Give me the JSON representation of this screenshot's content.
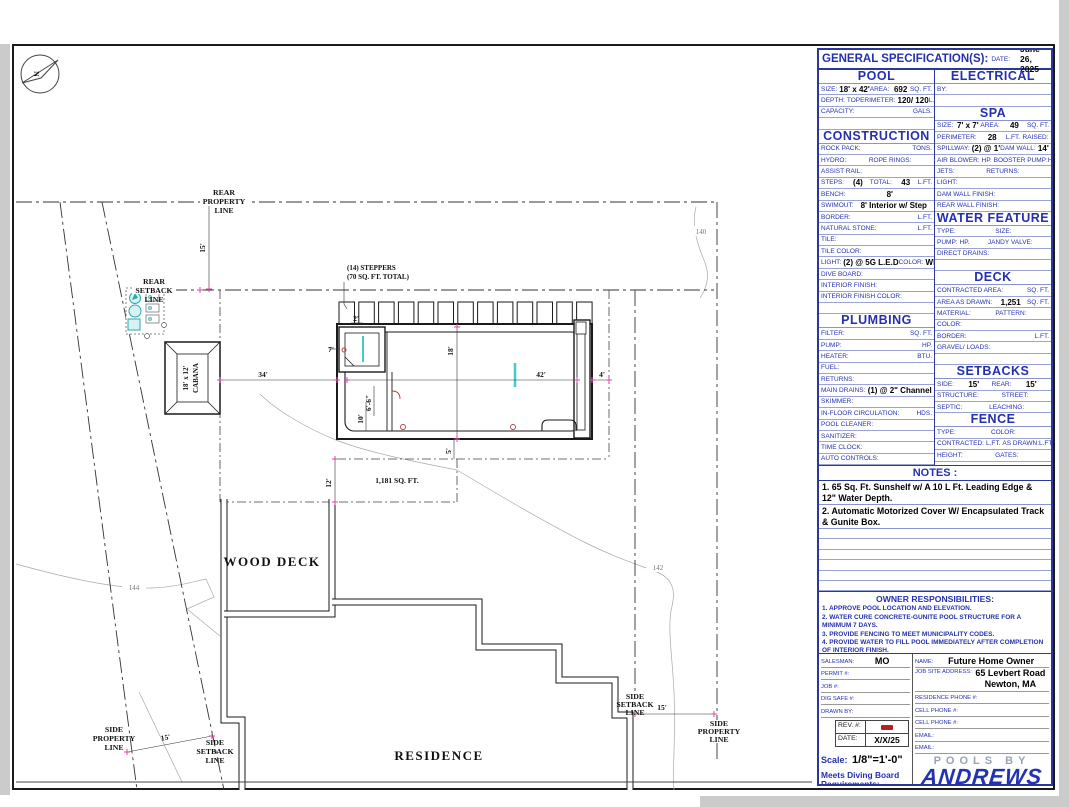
{
  "spec": {
    "title": "GENERAL SPECIFICATION(S):",
    "date_label": "DATE:",
    "date_value": "June 26, 2025",
    "left_sections": [
      {
        "header": "POOL",
        "rows": [
          [
            {
              "t": "SIZE:",
              "k": "l"
            },
            {
              "t": "18' x 42'",
              "k": "v"
            },
            {
              "t": "AREA:",
              "k": "l"
            },
            {
              "t": "692",
              "k": "v"
            },
            {
              "t": "SQ. FT.",
              "k": "r"
            }
          ],
          [
            {
              "t": "DEPTH:",
              "k": "l"
            },
            {
              "t": "TO",
              "k": "m"
            },
            {
              "t": "PERIMETER:",
              "k": "l"
            },
            {
              "t": "120/ 120",
              "k": "v"
            },
            {
              "t": "L.FT.",
              "k": "r"
            }
          ],
          [
            {
              "t": "CAPACITY:",
              "k": "l"
            },
            {
              "t": "GALS.",
              "k": "r"
            }
          ],
          []
        ]
      },
      {
        "header": "CONSTRUCTION",
        "rows": [
          [
            {
              "t": "ROCK PACK:",
              "k": "l"
            },
            {
              "t": "TONS.",
              "k": "r"
            }
          ],
          [
            {
              "t": "HYDRO:",
              "k": "l"
            },
            {
              "t": "ROPE RINGS:",
              "k": "m"
            }
          ],
          [
            {
              "t": "ASSIST RAIL:",
              "k": "l"
            }
          ],
          [
            {
              "t": "STEPS:",
              "k": "l"
            },
            {
              "t": "(4)",
              "k": "v"
            },
            {
              "t": "TOTAL:",
              "k": "l"
            },
            {
              "t": "43",
              "k": "v"
            },
            {
              "t": "L.FT.",
              "k": "r"
            }
          ],
          [
            {
              "t": "BENCH:",
              "k": "l"
            },
            {
              "t": "8'",
              "k": "v"
            }
          ],
          [
            {
              "t": "SWIMOUT:",
              "k": "l"
            },
            {
              "t": "8' Interior w/ Step",
              "k": "v"
            }
          ],
          [
            {
              "t": "BORDER:",
              "k": "l"
            },
            {
              "t": "L.FT.",
              "k": "r"
            }
          ],
          [
            {
              "t": "NATURAL STONE:",
              "k": "l"
            },
            {
              "t": "L.FT.",
              "k": "r"
            }
          ],
          [
            {
              "t": "TILE:",
              "k": "l"
            }
          ],
          [
            {
              "t": "TILE COLOR:",
              "k": "l"
            }
          ],
          [
            {
              "t": "LIGHT:",
              "k": "l"
            },
            {
              "t": "(2) @ 5G L.E.D",
              "k": "v"
            },
            {
              "t": "COLOR:",
              "k": "l"
            },
            {
              "t": "White",
              "k": "v"
            }
          ],
          [
            {
              "t": "DIVE BOARD:",
              "k": "l"
            }
          ],
          [
            {
              "t": "INTERIOR FINISH:",
              "k": "l"
            }
          ],
          [
            {
              "t": "INTERIOR FINISH COLOR:",
              "k": "l"
            }
          ],
          []
        ]
      },
      {
        "header": "PLUMBING",
        "rows": [
          [
            {
              "t": "FILTER:",
              "k": "l"
            },
            {
              "t": "SQ. FT.",
              "k": "r"
            }
          ],
          [
            {
              "t": "PUMP:",
              "k": "l"
            },
            {
              "t": "HP.",
              "k": "r"
            }
          ],
          [
            {
              "t": "HEATER:",
              "k": "l"
            },
            {
              "t": "BTU.",
              "k": "r"
            }
          ],
          [
            {
              "t": "FUEL:",
              "k": "l"
            }
          ],
          [
            {
              "t": "RETURNS:",
              "k": "l"
            }
          ],
          [
            {
              "t": "MAIN DRAINS:",
              "k": "l"
            },
            {
              "t": "(1) @ 2\" Channel",
              "k": "v"
            }
          ],
          [
            {
              "t": "SKIMMER:",
              "k": "l"
            }
          ],
          [
            {
              "t": "IN-FLOOR CIRCULATION:",
              "k": "l"
            },
            {
              "t": "HDS.",
              "k": "r"
            }
          ],
          [
            {
              "t": "POOL CLEANER:",
              "k": "l"
            }
          ],
          [
            {
              "t": "SANITIZER:",
              "k": "l"
            }
          ],
          [
            {
              "t": "TIME CLOCK:",
              "k": "l"
            }
          ],
          [
            {
              "t": "AUTO CONTROLS:",
              "k": "l"
            }
          ],
          []
        ]
      }
    ],
    "right_sections": [
      {
        "header": "ELECTRICAL",
        "rows": [
          [
            {
              "t": "BY:",
              "k": "l"
            }
          ],
          []
        ]
      },
      {
        "header": "SPA",
        "rows": [
          [
            {
              "t": "SIZE:",
              "k": "l"
            },
            {
              "t": "7' x 7'",
              "k": "v"
            },
            {
              "t": "AREA:",
              "k": "l"
            },
            {
              "t": "49",
              "k": "v"
            },
            {
              "t": "SQ. FT.",
              "k": "r"
            }
          ],
          [
            {
              "t": "PERIMETER:",
              "k": "l"
            },
            {
              "t": "28",
              "k": "v"
            },
            {
              "t": "L.FT.",
              "k": "l"
            },
            {
              "t": "RAISED:",
              "k": "m"
            }
          ],
          [
            {
              "t": "SPILLWAY:",
              "k": "l"
            },
            {
              "t": "(2) @ 1'",
              "k": "v"
            },
            {
              "t": "DAM WALL:",
              "k": "l"
            },
            {
              "t": "14'",
              "k": "v"
            }
          ],
          [
            {
              "t": "AIR BLOWER:",
              "k": "l"
            },
            {
              "t": "HP.",
              "k": "l"
            },
            {
              "t": "BOOSTER PUMP:",
              "k": "m"
            },
            {
              "t": "HP.",
              "k": "r"
            }
          ],
          [
            {
              "t": "JETS:",
              "k": "l"
            },
            {
              "t": "RETURNS:",
              "k": "m"
            }
          ],
          [
            {
              "t": "LIGHT:",
              "k": "l"
            }
          ],
          [
            {
              "t": "DAM WALL FINISH:",
              "k": "l"
            }
          ],
          [
            {
              "t": "REAR WALL FINISH:",
              "k": "l"
            }
          ]
        ]
      },
      {
        "header": "WATER FEATURE",
        "rows": [
          [
            {
              "t": "TYPE:",
              "k": "l"
            },
            {
              "t": "SIZE:",
              "k": "m"
            }
          ],
          [
            {
              "t": "PUMP:",
              "k": "l"
            },
            {
              "t": "HP.",
              "k": "l"
            },
            {
              "t": "JANDY VALVE:",
              "k": "m"
            }
          ],
          [
            {
              "t": "DIRECT DRAINS:",
              "k": "l"
            }
          ],
          []
        ]
      },
      {
        "header": "DECK",
        "rows": [
          [
            {
              "t": "CONTRACTED AREA:",
              "k": "l"
            },
            {
              "t": "SQ. FT.",
              "k": "r"
            }
          ],
          [
            {
              "t": "AREA AS DRAWN:",
              "k": "l"
            },
            {
              "t": "1,251",
              "k": "v"
            },
            {
              "t": "SQ. FT.",
              "k": "r"
            }
          ],
          [
            {
              "t": "MATERIAL:",
              "k": "l"
            },
            {
              "t": "PATTERN:",
              "k": "m"
            }
          ],
          [
            {
              "t": "COLOR:",
              "k": "l"
            }
          ],
          [
            {
              "t": "BORDER:",
              "k": "l"
            },
            {
              "t": "L.FT.",
              "k": "r"
            }
          ],
          [
            {
              "t": "GRAVEL/ LOADS:",
              "k": "l"
            }
          ],
          []
        ]
      },
      {
        "header": "SETBACKS",
        "rows": [
          [
            {
              "t": "SIDE:",
              "k": "l"
            },
            {
              "t": "15'",
              "k": "v"
            },
            {
              "t": "REAR:",
              "k": "l"
            },
            {
              "t": "15'",
              "k": "v"
            }
          ],
          [
            {
              "t": "STRUCTURE:",
              "k": "l"
            },
            {
              "t": "STREET:",
              "k": "m"
            }
          ],
          [
            {
              "t": "SEPTIC:",
              "k": "l"
            },
            {
              "t": "LEACHING:",
              "k": "m"
            }
          ]
        ]
      },
      {
        "header": "FENCE",
        "rows": [
          [
            {
              "t": "TYPE:",
              "k": "l"
            },
            {
              "t": "COLOR:",
              "k": "m"
            }
          ],
          [
            {
              "t": "CONTRACTED:",
              "k": "l"
            },
            {
              "t": "L.FT.",
              "k": "l"
            },
            {
              "t": "AS DRAWN:",
              "k": "m"
            },
            {
              "t": "L.FT.",
              "k": "r"
            }
          ],
          [
            {
              "t": "HEIGHT:",
              "k": "l"
            },
            {
              "t": "GATES:",
              "k": "m"
            }
          ],
          []
        ]
      }
    ],
    "notes": {
      "header": "NOTES :",
      "items": [
        "1. 65 Sq. Ft. Sunshelf w/ A 10 L Ft. Leading Edge & 12\" Water Depth.",
        "2. Automatic Motorized Cover W/ Encapsulated Track & Gunite Box."
      ],
      "empty_rows": 6
    },
    "owner": {
      "header": "OWNER RESPONSIBILITIES:",
      "items": [
        "1. APPROVE POOL LOCATION AND ELEVATION.",
        "2. WATER CURE CONCRETE-GUNITE POOL STRUCTURE FOR A MINIMUM 7 DAYS.",
        "3. PROVIDE FENCING TO MEET MUNICIPALITY CODES.",
        "4. PROVIDE WATER TO FILL POOL IMMEDIATELY AFTER COMPLETION OF INTERIOR FINISH."
      ]
    },
    "title_block": {
      "left_rows": [
        {
          "l": "SALESMAN:",
          "v": "MO"
        },
        {
          "l": "PERMIT #:",
          "v": ""
        },
        {
          "l": "JOB #:",
          "v": ""
        },
        {
          "l": "DIG SAFE #:",
          "v": ""
        },
        {
          "l": "DRAWN BY:",
          "v": ""
        }
      ],
      "rev_label": "REV. #:",
      "date_label": "DATE:",
      "date_value": "X/X/25",
      "scale_label": "Scale:",
      "scale_value": "1/8\"=1'-0\"",
      "diving_note": "Meets Diving Board Requirements:",
      "right_rows": [
        {
          "l": "NAME:",
          "v": "Future Home Owner"
        },
        {
          "l": "JOB SITE ADDRESS:",
          "v": "65 Levbert Road",
          "v2": "Newton, MA"
        },
        {
          "l": "RESIDENCE PHONE #:",
          "v": ""
        },
        {
          "l": "CELL PHONE #:",
          "v": ""
        },
        {
          "l": "CELL PHONE #:",
          "v": ""
        },
        {
          "l": "EMAIL:",
          "v": ""
        },
        {
          "l": "EMAIL:",
          "v": ""
        }
      ],
      "logo": {
        "pools_by": "POOLS BY",
        "name": "ANDREWS",
        "address": "6 REPUBLIC ROAD, NO. BILLERICA, MA 01862",
        "phone": "TELEPHONE: (800)272-7946"
      }
    }
  },
  "plan": {
    "north": "N",
    "rear_property": [
      "REAR",
      "PROPERTY",
      "LINE"
    ],
    "rear_setback": [
      "REAR",
      "SETBACK",
      "LINE"
    ],
    "side_property_left": [
      "SIDE",
      "PROPERTY",
      "LINE"
    ],
    "side_setback_left": [
      "SIDE",
      "SETBACK",
      "LINE"
    ],
    "side_setback_right": [
      "SIDE",
      "SETBACK",
      "LINE"
    ],
    "side_property_right": [
      "SIDE",
      "PROPERTY",
      "LINE"
    ],
    "cabana": [
      "18' x 12'",
      "CABANA"
    ],
    "steppers_note": [
      "(14) STEPPERS",
      "(70 SQ. FT. TOTAL)"
    ],
    "wood_deck": "WOOD DECK",
    "residence": "RESIDENCE",
    "deck_area": "1,181 SQ. FT.",
    "dims": {
      "rear_setback": "15'",
      "side_left": "15'",
      "side_right": "15'",
      "pool_width": "18'",
      "pool_length": "42'",
      "cabana_to_pool": "34'",
      "right_gap": "4'",
      "shelf_a": "6'-6\"",
      "shelf_b": "10'",
      "spa_a": "7'",
      "spa_b": "2'",
      "deck_depth": "12'",
      "step_gap": "5'"
    },
    "contours": {
      "c144": "144",
      "c142": "142",
      "c140": "140"
    }
  }
}
